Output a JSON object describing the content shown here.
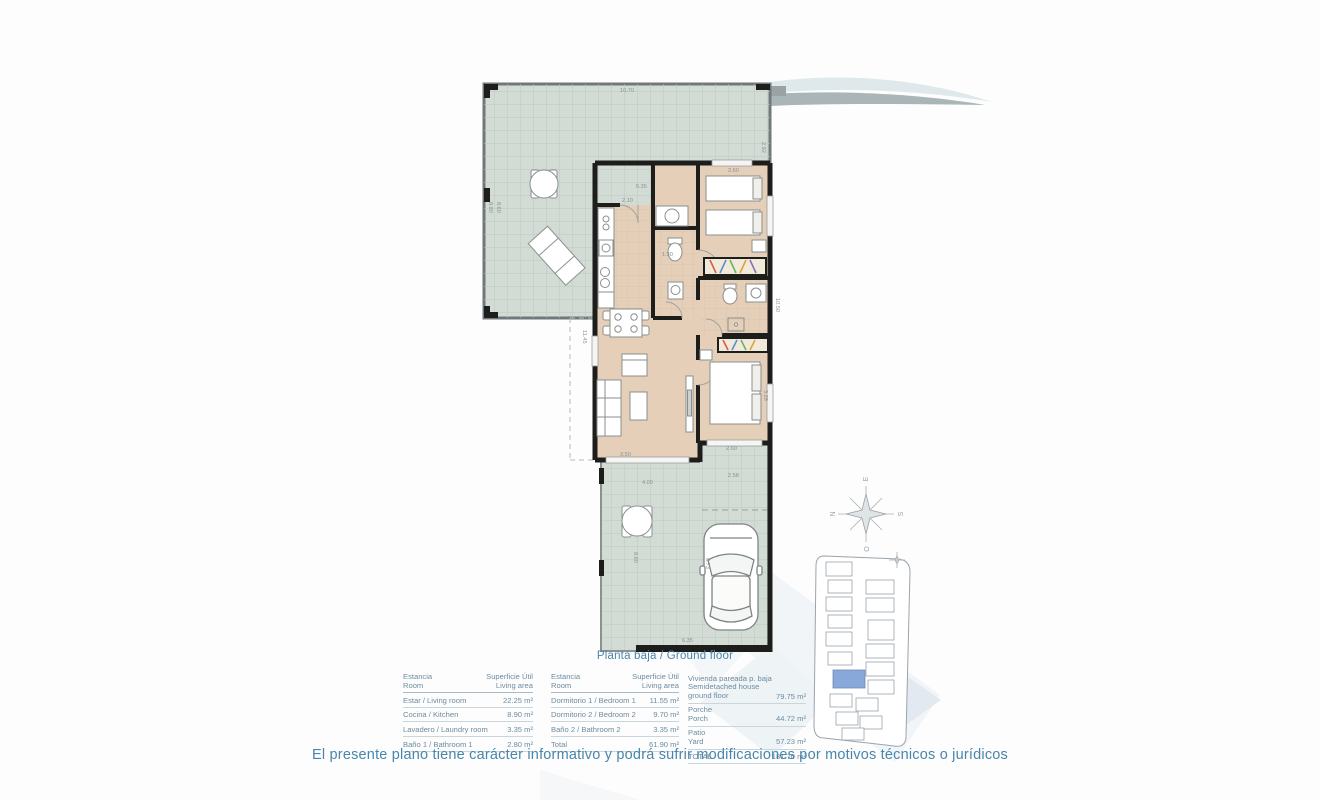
{
  "plan": {
    "caption": "Planta baja / Ground floor",
    "compass": {
      "top": "E",
      "left": "N",
      "right": "S",
      "bottom": "O"
    },
    "dimensions": {
      "terrace_top": "10.70",
      "terrace_right": "2.92",
      "terrace_left_a": "8.80",
      "terrace_left_b": "8.60",
      "porch_entry": "5.35",
      "kitchen": "2.10",
      "bedroom1_w": "2.60",
      "bath1": "1.30",
      "left_height": "11.45",
      "living_w": "3.50",
      "bedroom2_w": "2.60",
      "bedroom2_h": "3.28",
      "right_height": "10.50",
      "patio_gate": "2.58",
      "patio_w": "4.00",
      "patio_h": "8.80",
      "drive_h": "8.73",
      "patio_bottom": "6.35"
    }
  },
  "tables": {
    "rooms1": {
      "header": {
        "col1_es": "Estancia",
        "col1_en": "Room",
        "col2_es": "Superficie Útil",
        "col2_en": "Living area"
      },
      "rows": [
        {
          "label": "Estar / Living room",
          "value": "22.25 m²"
        },
        {
          "label": "Cocina / Kitchen",
          "value": "8.90 m²"
        },
        {
          "label": "Lavadero / Laundry room",
          "value": "3.35 m²"
        },
        {
          "label": "Baño 1 / Bathroom 1",
          "value": "2.80 m²"
        }
      ]
    },
    "rooms2": {
      "header": {
        "col1_es": "Estancia",
        "col1_en": "Room",
        "col2_es": "Superficie Útil",
        "col2_en": "Living area"
      },
      "rows": [
        {
          "label": "Dormitorio 1 / Bedroom 1",
          "value": "11.55 m²"
        },
        {
          "label": "Dormitorio 2 / Bedroom 2",
          "value": "9.70 m²"
        },
        {
          "label": "Baño 2 / Bathroom 2",
          "value": "3.35 m²"
        },
        {
          "label": "Total",
          "value": "61.90 m²"
        }
      ]
    },
    "summary": {
      "rows": [
        {
          "label_es": "Vivienda pareada p. baja",
          "label_en": "Semidetached house ground floor",
          "value": "79.75 m²"
        },
        {
          "label_es": "Porche",
          "label_en": "Porch",
          "value": "44.72 m²"
        },
        {
          "label_es": "Patio",
          "label_en": "Yard",
          "value": "57.23 m²"
        },
        {
          "label_es": "TOTAL",
          "label_en": "",
          "value": "181.70 m²"
        }
      ]
    }
  },
  "disclaimer": "El presente plano tiene carácter informativo y podrá sufrir modificaciones por motivos técnicos o jurídicos",
  "colors": {
    "accent_blue": "#4886ab",
    "table_text": "#6d8ca0",
    "terrace": "#d2dcd5",
    "floor": "#e5cfb9",
    "wall": "#1d1d1b",
    "highlight_unit": "#7b9fd4"
  }
}
